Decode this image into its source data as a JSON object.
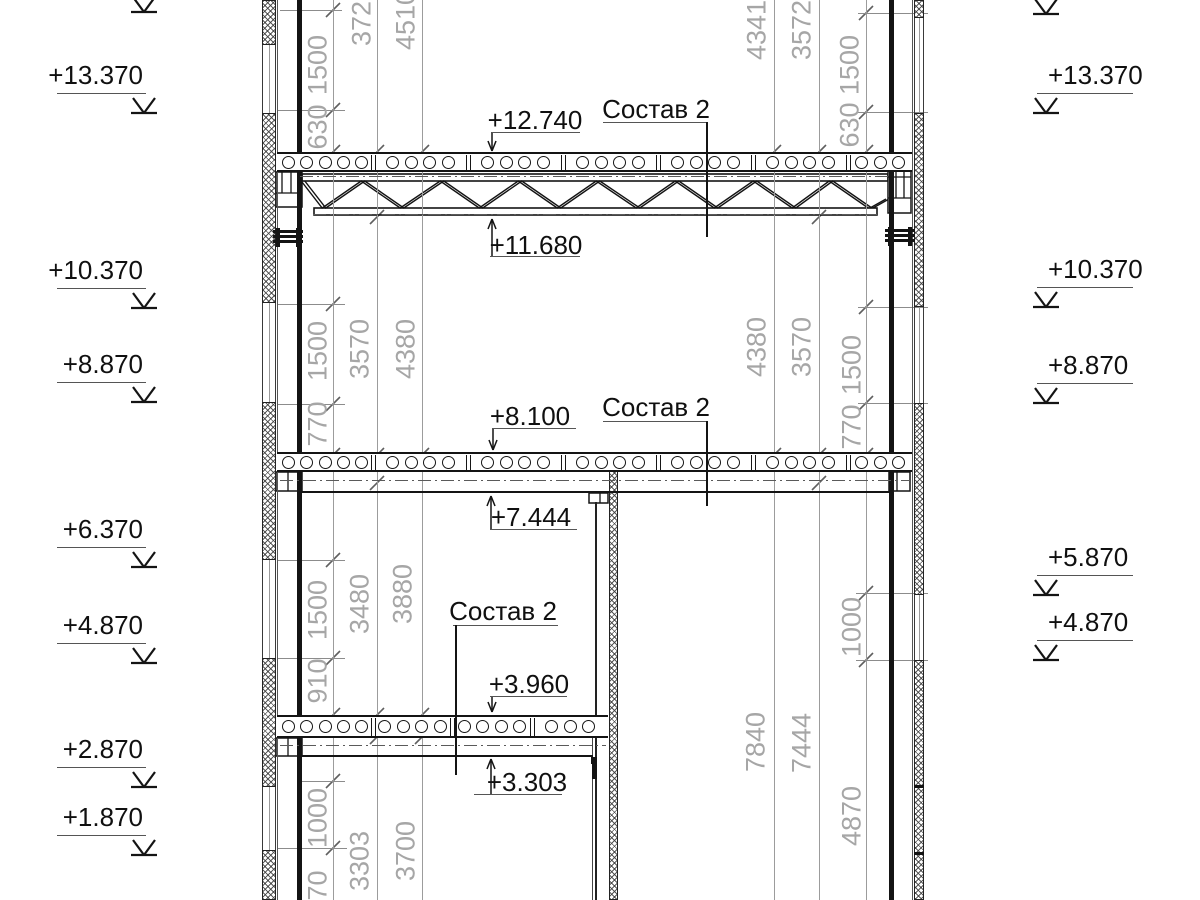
{
  "drawing_type": "structural-cross-section",
  "composition_label": "Состав 2",
  "colors": {
    "line": "#141414",
    "dim_text": "#a6a6a6",
    "thin": "#8c8c8c",
    "background": "#ffffff",
    "label_text": "#101010"
  },
  "elevations_left": [
    {
      "label": "+13.370",
      "line_y": 93
    },
    {
      "label": "+10.370",
      "line_y": 288
    },
    {
      "label": "+8.870",
      "line_y": 382
    },
    {
      "label": "+6.370",
      "line_y": 547
    },
    {
      "label": "+4.870",
      "line_y": 643
    },
    {
      "label": "+2.870",
      "line_y": 767
    },
    {
      "label": "+1.870",
      "line_y": 835
    }
  ],
  "elevations_right": [
    {
      "label": "+13.370",
      "line_y": 93
    },
    {
      "label": "+10.370",
      "line_y": 287
    },
    {
      "label": "+8.870",
      "line_y": 383
    },
    {
      "label": "+5.870",
      "line_y": 575
    },
    {
      "label": "+4.870",
      "line_y": 640
    }
  ],
  "top_cut_markers": [
    {
      "x": 144,
      "y": 12
    },
    {
      "x": 1046,
      "y": 14
    }
  ],
  "marker_left_x": 144,
  "marker_right_x": 1046,
  "underline_left": {
    "x1": 57,
    "x2": 146
  },
  "underline_right": {
    "x1": 1037,
    "x2": 1133
  },
  "level_labels": [
    {
      "label": "+12.740",
      "kind": "down",
      "tc": [
        535,
        120
      ],
      "rule": {
        "y": 132,
        "x1": 492,
        "x2": 580
      },
      "arrow": {
        "x": 492,
        "y1": 132,
        "y2": 151
      }
    },
    {
      "label": "+11.680",
      "kind": "up",
      "tc": [
        536,
        245
      ],
      "rule": {
        "y": 256,
        "x1": 490,
        "x2": 580
      },
      "arrow": {
        "x": 492,
        "y1": 256,
        "y2": 219
      }
    },
    {
      "label": "+8.100",
      "kind": "down",
      "tc": [
        530,
        416
      ],
      "rule": {
        "y": 428,
        "x1": 492,
        "x2": 576
      },
      "arrow": {
        "x": 493,
        "y1": 428,
        "y2": 450
      }
    },
    {
      "label": "+7.444",
      "kind": "up",
      "tc": [
        531,
        517
      ],
      "rule": {
        "y": 529,
        "x1": 490,
        "x2": 577
      },
      "arrow": {
        "x": 491,
        "y1": 529,
        "y2": 496
      }
    },
    {
      "label": "+3.960",
      "kind": "down",
      "tc": [
        529,
        684
      ],
      "rule": {
        "y": 696,
        "x1": 490,
        "x2": 567
      },
      "arrow": {
        "x": 492,
        "y1": 696,
        "y2": 712
      }
    },
    {
      "label": "+3.303",
      "kind": "up",
      "tc": [
        527,
        782
      ],
      "rule": {
        "y": 794,
        "x1": 474,
        "x2": 562
      },
      "arrow": {
        "x": 491,
        "y1": 794,
        "y2": 759
      }
    }
  ],
  "composition_labels": [
    {
      "tc": [
        656,
        109
      ],
      "rule": {
        "y": 122,
        "x1": 603,
        "x2": 706
      },
      "leader": {
        "x": 706,
        "y1": 122,
        "y2": 237
      }
    },
    {
      "tc": [
        656,
        407
      ],
      "rule": {
        "y": 421,
        "x1": 603,
        "x2": 706
      },
      "leader": {
        "x": 706,
        "y1": 421,
        "y2": 506
      }
    },
    {
      "tc": [
        503,
        611
      ],
      "rule": {
        "y": 625,
        "x1": 453,
        "x2": 558
      },
      "leader": {
        "x": 455,
        "y1": 625,
        "y2": 775
      }
    }
  ],
  "dim_texts": [
    {
      "x": 318,
      "y": 65,
      "t": "1500"
    },
    {
      "x": 318,
      "y": 127,
      "t": "630"
    },
    {
      "x": 362,
      "y": 16,
      "t": "3720"
    },
    {
      "x": 406,
      "y": 20,
      "t": "4510"
    },
    {
      "x": 318,
      "y": 351,
      "t": "1500"
    },
    {
      "x": 318,
      "y": 424,
      "t": "770"
    },
    {
      "x": 360,
      "y": 349,
      "t": "3570"
    },
    {
      "x": 406,
      "y": 349,
      "t": "4380"
    },
    {
      "x": 318,
      "y": 610,
      "t": "1500"
    },
    {
      "x": 318,
      "y": 681,
      "t": "910"
    },
    {
      "x": 360,
      "y": 604,
      "t": "3480"
    },
    {
      "x": 403,
      "y": 594,
      "t": "3880"
    },
    {
      "x": 318,
      "y": 818,
      "t": "1000"
    },
    {
      "x": 318,
      "y": 893,
      "t": "970"
    },
    {
      "x": 360,
      "y": 861,
      "t": "3303"
    },
    {
      "x": 406,
      "y": 851,
      "t": "3700"
    },
    {
      "x": 757,
      "y": 30,
      "t": "4341"
    },
    {
      "x": 802,
      "y": 30,
      "t": "3572"
    },
    {
      "x": 850,
      "y": 65,
      "t": "1500"
    },
    {
      "x": 850,
      "y": 125,
      "t": "630"
    },
    {
      "x": 757,
      "y": 347,
      "t": "4380"
    },
    {
      "x": 802,
      "y": 347,
      "t": "3570"
    },
    {
      "x": 852,
      "y": 365,
      "t": "1500"
    },
    {
      "x": 852,
      "y": 427,
      "t": "770"
    },
    {
      "x": 756,
      "y": 742,
      "t": "7840"
    },
    {
      "x": 802,
      "y": 743,
      "t": "7444"
    },
    {
      "x": 852,
      "y": 627,
      "t": "1000"
    },
    {
      "x": 852,
      "y": 816,
      "t": "4870"
    }
  ],
  "chains": [
    {
      "x": 333,
      "ticks": [
        10,
        110,
        152,
        304,
        404,
        455,
        560,
        658,
        715,
        781,
        848
      ]
    },
    {
      "x": 377,
      "ticks": [
        152,
        217,
        455,
        483,
        715,
        737
      ]
    },
    {
      "x": 422,
      "ticks": [
        152,
        163,
        455,
        715,
        737
      ]
    },
    {
      "x": 866,
      "ticks": [
        13,
        112,
        152,
        307,
        403,
        455,
        593,
        660
      ]
    },
    {
      "x": 819,
      "ticks": [
        152,
        217,
        455,
        483
      ]
    },
    {
      "x": 774,
      "ticks": [
        152,
        163,
        455
      ]
    }
  ],
  "extensions": [
    {
      "y": 10,
      "x1": 280,
      "x2": 342
    },
    {
      "y": 110,
      "x1": 278,
      "x2": 345
    },
    {
      "y": 304,
      "x1": 278,
      "x2": 345
    },
    {
      "y": 404,
      "x1": 278,
      "x2": 345
    },
    {
      "y": 560,
      "x1": 278,
      "x2": 345
    },
    {
      "y": 658,
      "x1": 278,
      "x2": 345
    },
    {
      "y": 781,
      "x1": 300,
      "x2": 345
    },
    {
      "y": 848,
      "x1": 278,
      "x2": 347
    },
    {
      "y": 13,
      "x1": 858,
      "x2": 928
    },
    {
      "y": 112,
      "x1": 858,
      "x2": 928
    },
    {
      "y": 307,
      "x1": 858,
      "x2": 928
    },
    {
      "y": 403,
      "x1": 858,
      "x2": 928
    },
    {
      "y": 593,
      "x1": 856,
      "x2": 928
    },
    {
      "y": 660,
      "x1": 856,
      "x2": 928
    }
  ],
  "walls": {
    "left": {
      "band_x": 262,
      "band_w": 14,
      "col_x": 297,
      "col_w": 5,
      "face_x": 277,
      "hatch": [
        [
          0,
          45
        ],
        [
          113,
          303
        ],
        [
          402,
          560
        ],
        [
          658,
          787
        ],
        [
          850,
          900
        ]
      ],
      "windows": [
        [
          45,
          113
        ],
        [
          303,
          402
        ],
        [
          560,
          658
        ],
        [
          787,
          850
        ]
      ]
    },
    "right": {
      "band_x": 914,
      "band_w": 10,
      "col_x": 889,
      "col_w": 5,
      "face_x": 912,
      "hatch": [
        [
          0,
          18
        ],
        [
          113,
          307
        ],
        [
          403,
          595
        ],
        [
          660,
          900
        ]
      ],
      "joints": [
        785,
        852
      ],
      "windows": [
        [
          18,
          113
        ],
        [
          307,
          403
        ],
        [
          595,
          660
        ]
      ]
    },
    "interior": {
      "hatch_x": 609,
      "hatch_w": 9,
      "hatch_y1": 470,
      "hatch_y2": 900,
      "line_x": 595,
      "line_y1": 502,
      "line_y2": 900,
      "line2_x": 592,
      "line2_y1": 738,
      "line2_y2": 900,
      "stub": {
        "x": 592,
        "y": 757,
        "w": 5,
        "h": 22
      }
    }
  },
  "slabs": [
    {
      "y": 152,
      "h": 20,
      "planks": [
        277,
        373,
        468,
        563,
        658,
        753,
        848,
        912
      ]
    },
    {
      "y": 452,
      "h": 20,
      "planks": [
        277,
        373,
        468,
        563,
        658,
        753,
        848,
        912
      ]
    },
    {
      "y": 715,
      "h": 23,
      "planks": [
        277,
        373,
        452,
        532,
        608
      ]
    }
  ],
  "ceilings": [
    {
      "y": 491,
      "x1": 300,
      "x2": 889,
      "ticks": [
        300
      ]
    },
    {
      "y": 755,
      "x1": 300,
      "x2": 593,
      "ticks": [
        300,
        591
      ]
    }
  ],
  "dashdots": [
    {
      "y": 176,
      "x1": 300,
      "x2": 888
    },
    {
      "y": 214,
      "x1": 313,
      "x2": 877
    },
    {
      "y": 480,
      "x1": 280,
      "x2": 910
    },
    {
      "y": 745,
      "x1": 280,
      "x2": 606
    }
  ],
  "truss": {
    "top": {
      "x1": 302,
      "x2": 888,
      "y1": 174,
      "y2": 181
    },
    "bot": {
      "x1": 314,
      "x2": 877,
      "y1": 208,
      "y2": 215
    },
    "web_y_top": 181,
    "web_y_bot": 208,
    "web_start_x": 303,
    "bottom_nodes": [
      324,
      402,
      481,
      559,
      638,
      716,
      794,
      870
    ],
    "top_nodes": [
      363,
      442,
      520,
      598,
      677,
      755,
      831
    ],
    "end_diag": [
      [
        870,
        208
      ],
      [
        886,
        199
      ]
    ]
  },
  "supports": [
    {
      "type": "grid",
      "x": 276,
      "y": 172,
      "w": 26,
      "h": 35,
      "hdiv": [
        193
      ],
      "vdiv": [
        282,
        291
      ]
    },
    {
      "type": "grid",
      "x": 888,
      "y": 170,
      "w": 23,
      "h": 43,
      "hdiv": [
        177,
        198
      ],
      "vdiv": [
        896,
        904
      ]
    },
    {
      "type": "grid",
      "x": 276,
      "y": 472,
      "w": 26,
      "h": 19,
      "hdiv": [],
      "vdiv": [
        288
      ]
    },
    {
      "type": "grid",
      "x": 889,
      "y": 472,
      "w": 21,
      "h": 19,
      "hdiv": [],
      "vdiv": [
        897
      ]
    },
    {
      "type": "grid",
      "x": 276,
      "y": 738,
      "w": 26,
      "h": 18,
      "hdiv": [],
      "vdiv": [
        288
      ]
    },
    {
      "type": "grid",
      "x": 589,
      "y": 493,
      "w": 19,
      "h": 10,
      "hdiv": [],
      "vdiv": [
        600
      ]
    }
  ],
  "bolt_brackets": [
    {
      "x": 275,
      "y": 228,
      "w": 26,
      "h": 19
    },
    {
      "x": 887,
      "y": 227,
      "w": 26,
      "h": 19
    }
  ]
}
